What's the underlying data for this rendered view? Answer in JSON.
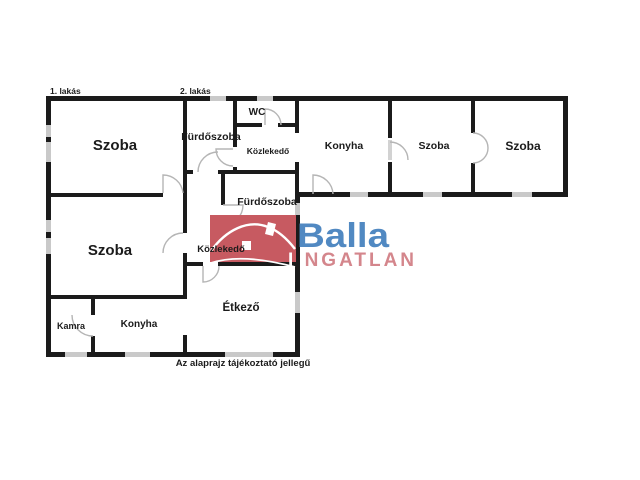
{
  "apartments": {
    "apartment_1": "1. lakás",
    "apartment_2": "2. lakás"
  },
  "rooms": {
    "szoba_1": "Szoba",
    "furdoszoba_1": "Fürdőszoba",
    "wc": "WC",
    "kozlekedo_1": "Közlekedő",
    "konyha_2": "Konyha",
    "szoba_3": "Szoba",
    "szoba_4": "Szoba",
    "furdoszoba_2": "Fürdőszoba",
    "kozlekedo_2": "Közlekedő",
    "szoba_2": "Szoba",
    "kamra": "Kamra",
    "konyha_1": "Konyha",
    "etkezo": "Étkező"
  },
  "footer": {
    "disclaimer": "Az alaprajz tájékoztató jellegű"
  },
  "logo": {
    "brand": "Balla",
    "subtitle_prefix": "I",
    "subtitle_suffix": "NGATLAN",
    "box_color": "#c75a61",
    "brand_color": "#5189c2",
    "subtitle_prefix_color": "#ffffff",
    "subtitle_color": "#d4868c",
    "house_color": "#ffffff"
  },
  "colors": {
    "wall": "#1b1b1b",
    "window": "#c9c9c9",
    "door": "#b5b5b5",
    "door_leaf": "#d2d2d2"
  }
}
